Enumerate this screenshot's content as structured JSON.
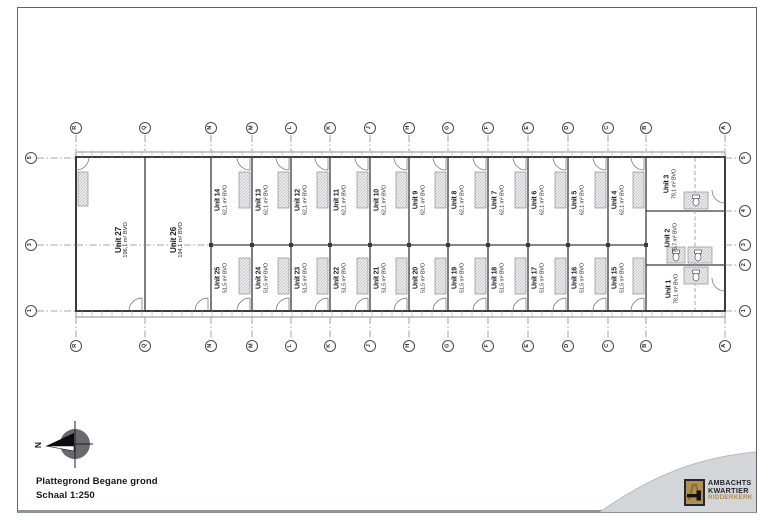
{
  "document": {
    "title": "Plattegrond Begane grond",
    "scale": "Schaal 1:250"
  },
  "compass": {
    "label": "N"
  },
  "grid": {
    "columns": [
      "R",
      "Q",
      "N",
      "M",
      "L",
      "K",
      "J",
      "H",
      "G",
      "F",
      "E",
      "D",
      "C",
      "B",
      "A"
    ],
    "rows_left": [
      "5",
      "3",
      "1"
    ],
    "rows_right": [
      "5",
      "4",
      "3",
      "2",
      "1"
    ]
  },
  "units": {
    "large": [
      {
        "name": "Unit 27",
        "area": "196,1 m² BVO"
      },
      {
        "name": "Unit 26",
        "area": "194,1 m² BVO"
      }
    ],
    "top_row": [
      {
        "name": "Unit 14",
        "area": "62,1 m² BVO"
      },
      {
        "name": "Unit 13",
        "area": "62,1 m² BVO"
      },
      {
        "name": "Unit 12",
        "area": "62,1 m² BVO"
      },
      {
        "name": "Unit 11",
        "area": "62,1 m² BVO"
      },
      {
        "name": "Unit 10",
        "area": "62,1 m² BVO"
      },
      {
        "name": "Unit 9",
        "area": "62,1 m² BVO"
      },
      {
        "name": "Unit 8",
        "area": "62,1 m² BVO"
      },
      {
        "name": "Unit 7",
        "area": "62,1 m² BVO"
      },
      {
        "name": "Unit 6",
        "area": "62,1 m² BVO"
      },
      {
        "name": "Unit 5",
        "area": "62,1 m² BVO"
      },
      {
        "name": "Unit 4",
        "area": "62,1 m² BVO"
      }
    ],
    "bottom_row": [
      {
        "name": "Unit 25",
        "area": "51,5 m² BVO"
      },
      {
        "name": "Unit 24",
        "area": "51,5 m² BVO"
      },
      {
        "name": "Unit 23",
        "area": "51,5 m² BVO"
      },
      {
        "name": "Unit 22",
        "area": "51,5 m² BVO"
      },
      {
        "name": "Unit 21",
        "area": "51,5 m² BVO"
      },
      {
        "name": "Unit 20",
        "area": "51,5 m² BVO"
      },
      {
        "name": "Unit 19",
        "area": "51,5 m² BVO"
      },
      {
        "name": "Unit 18",
        "area": "51,5 m² BVO"
      },
      {
        "name": "Unit 17",
        "area": "51,5 m² BVO"
      },
      {
        "name": "Unit 16",
        "area": "51,5 m² BVO"
      },
      {
        "name": "Unit 15",
        "area": "51,5 m² BVO"
      }
    ],
    "right_bay": [
      {
        "name": "Unit 3",
        "area": "78,1 m² BVO"
      },
      {
        "name": "Unit 2",
        "area": "75,7 m² BVO"
      },
      {
        "name": "Unit 1",
        "area": "78,1 m² BVO"
      }
    ]
  },
  "logo": {
    "line1": "AMBACHTS",
    "line2": "KWARTIER",
    "line3": "RIDDERKERK",
    "accent": "#b08f4f",
    "dark": "#23232e"
  },
  "colors": {
    "wall": "#3a3a40",
    "grid_line": "#8a8a8e",
    "swoosh": "#d4d5d8"
  }
}
